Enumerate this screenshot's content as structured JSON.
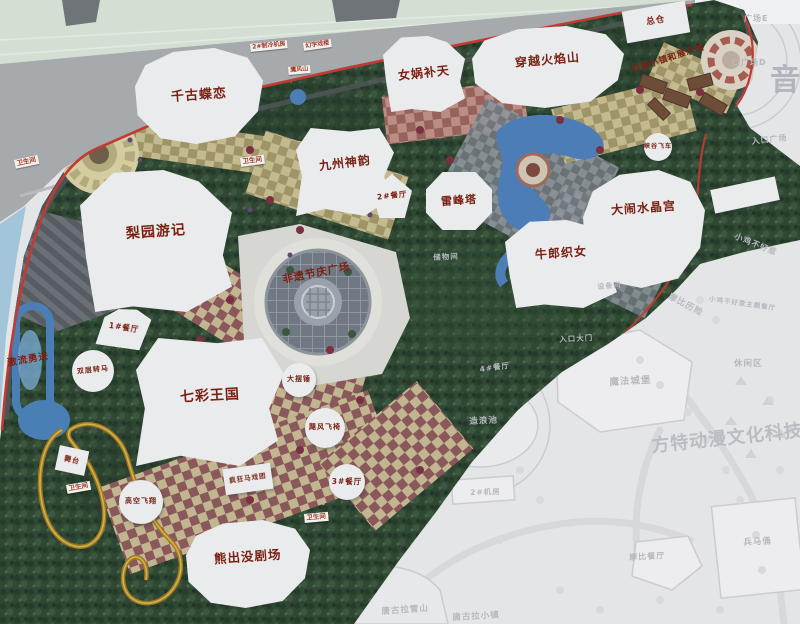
{
  "map": {
    "colors": {
      "label_red": "#7b2113",
      "boundary_red": "#c23b33",
      "faded_text": "#b5b9be",
      "building_fill": "#eaebed",
      "water_blue": "#4c7db6",
      "foliage_green": "#2f4733"
    },
    "buildings": [
      {
        "id": "attraction-qiangudielian",
        "label": "千古蝶恋",
        "x": 135,
        "y": 48,
        "w": 128,
        "h": 96,
        "shape": "blob1",
        "fs": 13,
        "lrot": -4
      },
      {
        "id": "attraction-nuwabutian",
        "label": "女娲补天",
        "x": 383,
        "y": 36,
        "w": 82,
        "h": 76,
        "shape": "blob2",
        "fs": 12,
        "lrot": -6
      },
      {
        "id": "attraction-chuanyuehuoyanshan",
        "label": "穿越火焰山",
        "x": 472,
        "y": 26,
        "w": 152,
        "h": 82,
        "shape": "blob1",
        "fs": 12,
        "lrot": -5,
        "ldy": -6
      },
      {
        "id": "attraction-jiuzhoushenyun",
        "label": "九州神韵",
        "x": 296,
        "y": 128,
        "w": 98,
        "h": 88,
        "shape": "blob3",
        "fs": 12,
        "lrot": -7,
        "ldy": -8
      },
      {
        "id": "attraction-liyuanyouji",
        "label": "梨园游记",
        "x": 80,
        "y": 170,
        "w": 152,
        "h": 142,
        "shape": "blob2",
        "fs": 14,
        "lrot": -4,
        "ldy": -8
      },
      {
        "id": "attraction-leifengta",
        "label": "雷峰塔",
        "x": 426,
        "y": 172,
        "w": 66,
        "h": 58,
        "shape": "hex",
        "fs": 11,
        "lrot": -4
      },
      {
        "id": "attraction-danaoshuijinggong",
        "label": "大闹水晶宫",
        "x": 583,
        "y": 170,
        "w": 122,
        "h": 118,
        "shape": "blob1",
        "fs": 12,
        "lrot": -4,
        "ldy": -20
      },
      {
        "id": "attraction-niulangzhinv",
        "label": "牛郎织女",
        "x": 505,
        "y": 220,
        "w": 112,
        "h": 88,
        "shape": "blob2",
        "fs": 12,
        "lrot": -4,
        "ldy": -10
      },
      {
        "id": "attraction-qicaiwangguo",
        "label": "七彩王国",
        "x": 136,
        "y": 338,
        "w": 148,
        "h": 128,
        "shape": "blob3",
        "fs": 14,
        "lrot": -3,
        "ldy": -5
      },
      {
        "id": "attraction-xiongchumo-theater",
        "label": "熊出没剧场",
        "x": 186,
        "y": 520,
        "w": 124,
        "h": 88,
        "shape": "blob1",
        "fs": 12.5,
        "lrot": -4,
        "ldy": -7
      },
      {
        "id": "building-zongcang",
        "label": "总仓",
        "x": 624,
        "y": 6,
        "w": 64,
        "h": 32,
        "shape": "rect",
        "rot": -10,
        "fs": 8.5
      },
      {
        "id": "restaurant-2",
        "label": "2#餐厅",
        "x": 372,
        "y": 174,
        "w": 40,
        "h": 44,
        "shape": "pent",
        "fs": 7.5,
        "lrot": -6
      },
      {
        "id": "restaurant-1",
        "label": "1#餐厅",
        "x": 98,
        "y": 308,
        "w": 52,
        "h": 40,
        "shape": "fan",
        "rot": 8,
        "fs": 7.5
      },
      {
        "id": "ride-shuangcengzhuanma",
        "label": "双层转马",
        "x": 72,
        "y": 350,
        "w": 42,
        "h": 42,
        "shape": "circle",
        "fs": 7,
        "lrot": -6
      },
      {
        "id": "ride-dabaichui",
        "label": "大摆锤",
        "x": 282,
        "y": 363,
        "w": 34,
        "h": 34,
        "shape": "circle",
        "fs": 7
      },
      {
        "id": "ride-jufengfeiyi",
        "label": "飓风飞椅",
        "x": 305,
        "y": 408,
        "w": 40,
        "h": 40,
        "shape": "circle",
        "fs": 7
      },
      {
        "id": "restaurant-3",
        "label": "3#餐厅",
        "x": 329,
        "y": 464,
        "w": 36,
        "h": 36,
        "shape": "circle",
        "fs": 7.5
      },
      {
        "id": "ride-gaokongfeixiang",
        "label": "高空飞翔",
        "x": 119,
        "y": 480,
        "w": 44,
        "h": 44,
        "shape": "circle",
        "fs": 7
      },
      {
        "id": "ride-xiagufeiche",
        "label": "峡谷飞车",
        "x": 644,
        "y": 133,
        "w": 28,
        "h": 28,
        "shape": "circle",
        "fs": 6
      },
      {
        "id": "ride-fengkuangmaxituan",
        "label": "疯狂马戏团",
        "x": 224,
        "y": 466,
        "w": 48,
        "h": 26,
        "shape": "rect",
        "rot": -8,
        "fs": 6.5
      },
      {
        "id": "stage-wutai",
        "label": "舞台",
        "x": 57,
        "y": 448,
        "w": 30,
        "h": 25,
        "shape": "rect",
        "rot": 12,
        "fs": 7
      },
      {
        "id": "building-right-strip",
        "label": "",
        "x": 712,
        "y": 183,
        "w": 66,
        "h": 24,
        "shape": "rect",
        "rot": -12,
        "fs": 7
      }
    ],
    "tags": [
      {
        "id": "restroom-tag-west",
        "label": "卫生间",
        "x": 14,
        "y": 160,
        "rot": -12,
        "fs": 6.5
      },
      {
        "id": "restroom-tag-center",
        "label": "卫生间",
        "x": 240,
        "y": 158,
        "rot": -8,
        "fs": 6.5
      },
      {
        "id": "restroom-tag-southwest",
        "label": "卫生间",
        "x": 66,
        "y": 485,
        "rot": -10,
        "fs": 6.5
      },
      {
        "id": "restroom-tag-south",
        "label": "卫生间",
        "x": 304,
        "y": 514,
        "rot": -5,
        "fs": 6.5
      },
      {
        "id": "chiller-room-tag",
        "label": "2#制冷机房",
        "x": 250,
        "y": 44,
        "rot": -6,
        "fs": 6
      },
      {
        "id": "huanyu-theater-tag",
        "label": "幻宇戏楼",
        "x": 303,
        "y": 43,
        "rot": -8,
        "fs": 6
      },
      {
        "id": "yingfengshan-tag",
        "label": "鹰风山",
        "x": 288,
        "y": 67,
        "rot": -5,
        "fs": 6
      }
    ],
    "floating_labels": [
      {
        "id": "ride-jiliuyongjin",
        "label": "激流勇进",
        "x": 6,
        "y": 355,
        "rot": -10,
        "fs": 9.5
      },
      {
        "id": "plaza-feiyi-festival",
        "label": "非遗节庆广场",
        "x": 281,
        "y": 272,
        "rot": -11,
        "fs": 10.5
      },
      {
        "id": "feiyi-town-exhibition",
        "label": "非遗小镇和展示馆",
        "x": 630,
        "y": 64,
        "rot": -18,
        "fs": 8.5
      }
    ],
    "faded_labels": [
      {
        "id": "faded-plaza-e",
        "label": "广场E",
        "x": 744,
        "y": 13,
        "fs": 8,
        "rot": 0
      },
      {
        "id": "faded-plaza-d",
        "label": "口广场D",
        "x": 732,
        "y": 57,
        "fs": 8,
        "rot": 0
      },
      {
        "id": "faded-entrance-plaza",
        "label": "入口广场",
        "x": 751,
        "y": 136,
        "fs": 8,
        "rot": -6
      },
      {
        "id": "faded-yin-watermark",
        "label": "音",
        "x": 770,
        "y": 55,
        "fs": 30,
        "rot": 0
      },
      {
        "id": "faded-storage",
        "label": "储物间",
        "x": 433,
        "y": 252,
        "fs": 7.5,
        "rot": -3
      },
      {
        "id": "faded-equipment-room",
        "label": "设备间",
        "x": 597,
        "y": 282,
        "fs": 7,
        "rot": -5
      },
      {
        "id": "faded-entrance-gate",
        "label": "入口大门",
        "x": 559,
        "y": 334,
        "fs": 7.5,
        "rot": -3
      },
      {
        "id": "faded-restaurant-4",
        "label": "4#餐厅",
        "x": 479,
        "y": 364,
        "fs": 7.5,
        "rot": -8
      },
      {
        "id": "faded-wave-pool",
        "label": "造浪池",
        "x": 469,
        "y": 415,
        "fs": 8.5,
        "rot": -3
      },
      {
        "id": "faded-magic-castle",
        "label": "魔法城堡",
        "x": 609,
        "y": 374,
        "fs": 9.5,
        "rot": -3
      },
      {
        "id": "faded-machine-room-2",
        "label": "2#机房",
        "x": 470,
        "y": 487,
        "fs": 7.5,
        "rot": -2
      },
      {
        "id": "faded-mobi-adventure",
        "label": "摩比历险",
        "x": 672,
        "y": 290,
        "fs": 8.5,
        "rot": 28
      },
      {
        "id": "faded-xiaoji",
        "label": "小鸡不好惹",
        "x": 737,
        "y": 231,
        "fs": 8,
        "rot": 22
      },
      {
        "id": "faded-xiaoji-restaurant",
        "label": "小鸡不好惹主题餐厅",
        "x": 710,
        "y": 293,
        "fs": 6.5,
        "rot": 8
      },
      {
        "id": "faded-leisure-area",
        "label": "休闲区",
        "x": 734,
        "y": 357,
        "fs": 8.5,
        "rot": 0
      },
      {
        "id": "faded-fantawild-watermark",
        "label": "方特动漫文化科技",
        "x": 650,
        "y": 432,
        "fs": 18,
        "rot": -6
      },
      {
        "id": "faded-terracotta",
        "label": "兵马俑",
        "x": 743,
        "y": 536,
        "fs": 8.5,
        "rot": -3
      },
      {
        "id": "faded-mobi-restaurant",
        "label": "摩比餐厅",
        "x": 629,
        "y": 552,
        "fs": 8,
        "rot": -3
      },
      {
        "id": "faded-tanggula-mountain",
        "label": "唐古拉雪山",
        "x": 381,
        "y": 605,
        "fs": 8.5,
        "rot": -4
      },
      {
        "id": "faded-tanggula-town",
        "label": "唐古拉小镇",
        "x": 452,
        "y": 611,
        "fs": 8.5,
        "rot": -3
      }
    ]
  }
}
